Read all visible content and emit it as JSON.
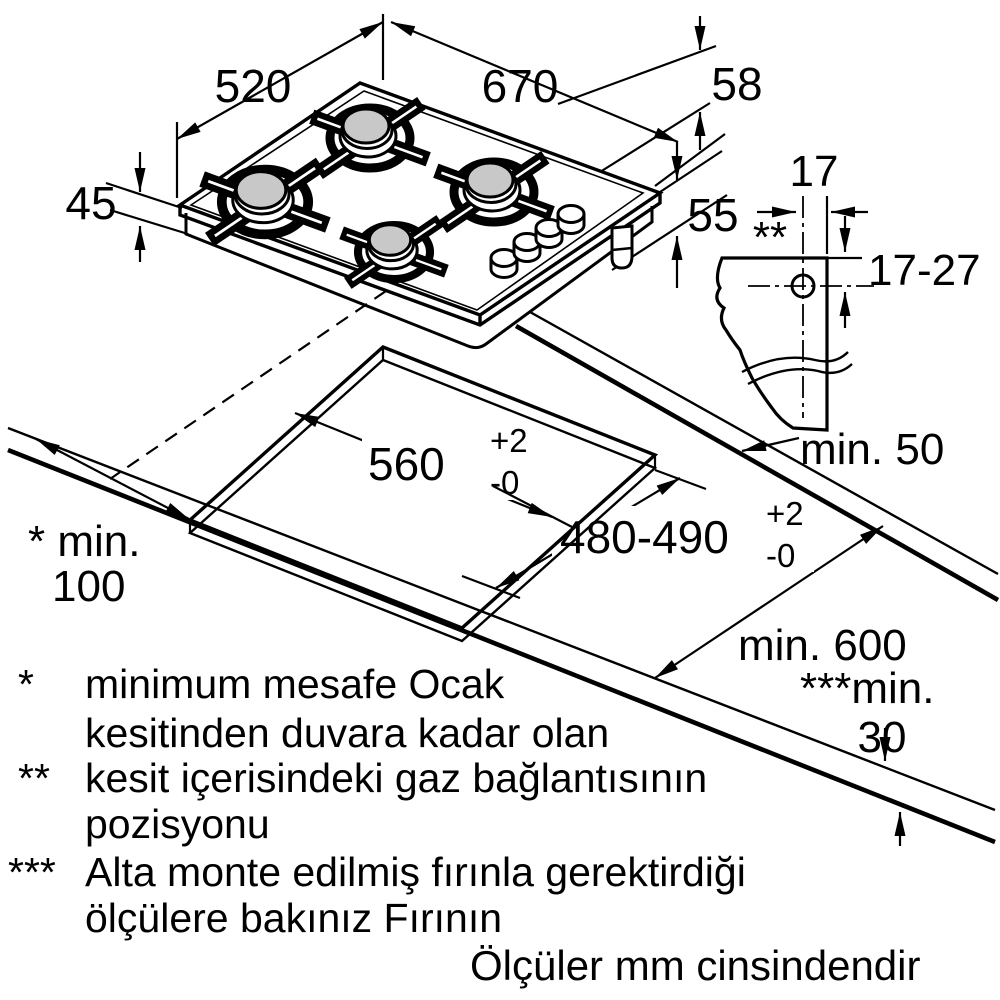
{
  "drawing": {
    "kind": "gas hob installation dimension diagram",
    "units_note": "Ölçüler mm cinsindendir"
  },
  "dims": {
    "hob_width": "670",
    "hob_depth": "520",
    "hob_height": "45",
    "below_top_58": "58",
    "below_top_55": "55",
    "gas_offset_17": "17",
    "gas_range_17_27": "17-27",
    "gas_marker": "**",
    "cutout_width": "560",
    "cutout_width_tol_plus": "+2",
    "cutout_width_tol_minus": "-0",
    "cutout_depth": "480-490",
    "cutout_depth_tol_plus": "+2",
    "cutout_depth_tol_minus": "-0",
    "min_side": "min. 50",
    "min_wall_label": "* min.",
    "min_wall_value": "100",
    "min_worktop_depth": "min. 600",
    "min_under_label": "***min.",
    "min_under_value": "30"
  },
  "footnotes": [
    {
      "marker": "*",
      "line1": "minimum mesafe Ocak",
      "line2": "kesitinden duvara kadar olan"
    },
    {
      "marker": "**",
      "line1": "kesit içerisindeki gaz bağlantısının",
      "line2": "pozisyonu"
    },
    {
      "marker": "***",
      "line1": "Alta monte edilmiş fırınla gerektirdiği",
      "line2": "ölçülere bakınız Fırının"
    }
  ],
  "colors": {
    "line": "#000000",
    "burner_cap": "#c8c8c8",
    "background": "#ffffff"
  }
}
